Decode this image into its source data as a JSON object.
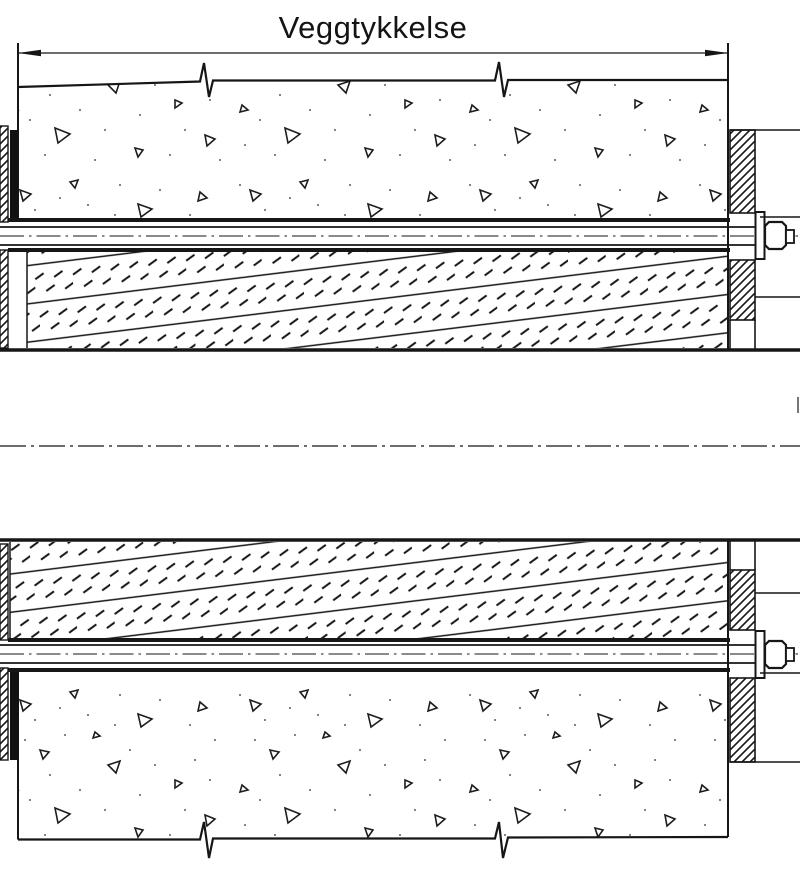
{
  "drawing": {
    "type": "technical-section-detail",
    "dimension": {
      "label": "Veggtykkelse"
    },
    "colors": {
      "ink": "#161616",
      "background": "#ffffff",
      "sealant_fill": "#111111",
      "fragment_gray": "#555555"
    },
    "components": {
      "wall": "concrete-wall-section",
      "insulation": "pipe-insulation-hatch",
      "rod_upper": "threaded-rod-with-nut",
      "rod_lower": "threaded-rod-with-nut",
      "flange_left": "edge-flange-hatched",
      "flange_right": "flange-plate-hatched",
      "pipe": "pipe-through-wall",
      "centerline": "dash-dot-centerline"
    }
  }
}
